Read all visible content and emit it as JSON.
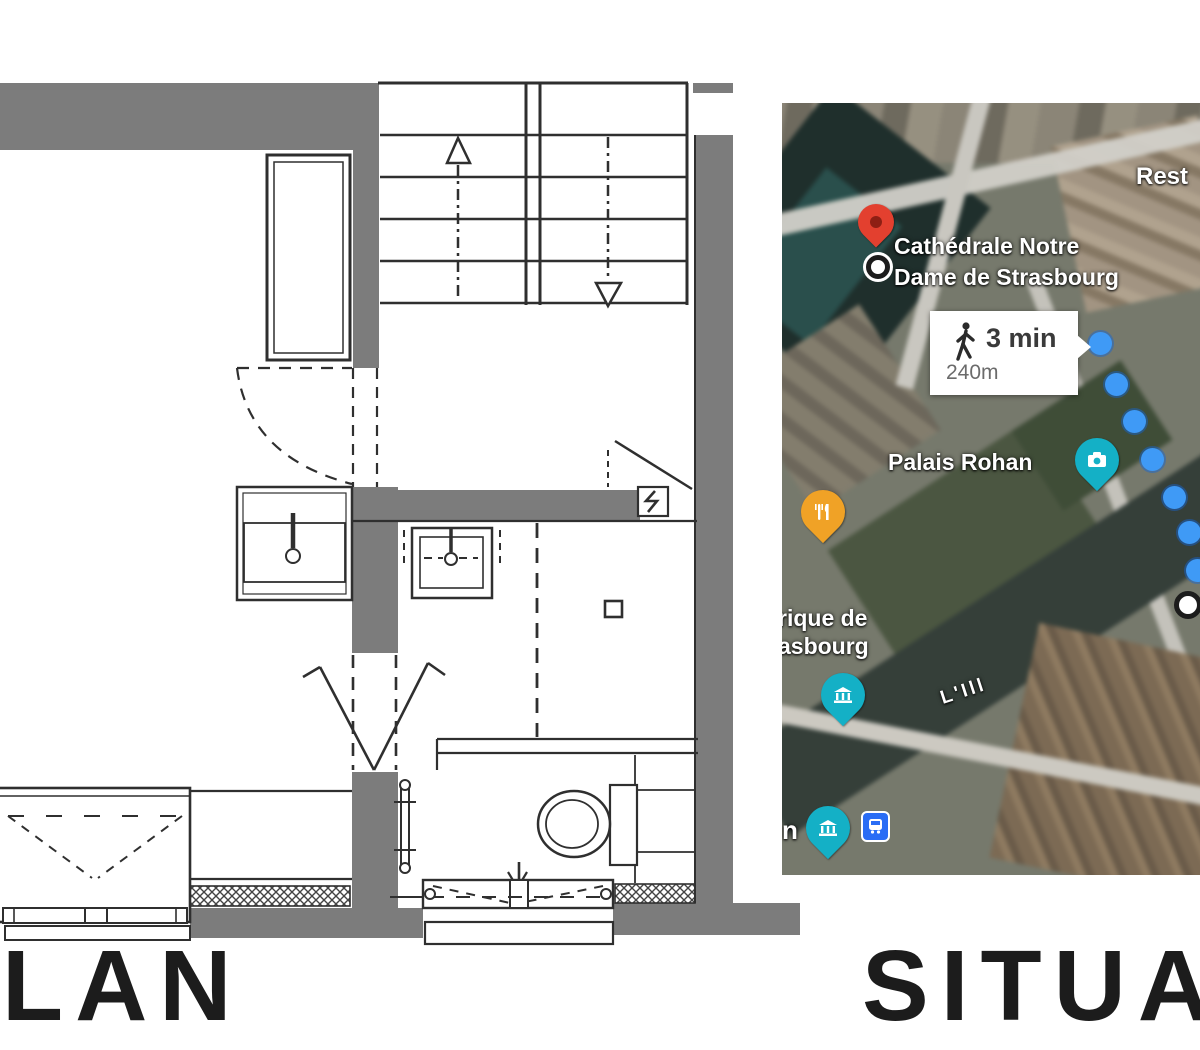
{
  "captions": {
    "left": "LAN",
    "right": "SITUA"
  },
  "floor_plan": {
    "wall_color": "#7c7c7c",
    "line_color": "#2f2f2f",
    "fixtures": [
      "staircase-up",
      "staircase-down",
      "closet",
      "sink",
      "washbasin",
      "toilet",
      "french-window",
      "window",
      "entrance-door-swing",
      "radiator",
      "electrical-panel"
    ]
  },
  "map": {
    "poi": {
      "cathedral_line1": "Cathédrale Notre",
      "cathedral_line2": "Dame de Strasbourg",
      "palais": "Palais Rohan",
      "museum_partial_line1": "rique de",
      "museum_partial_line2": "asbourg",
      "restaurant_partial": "Rest",
      "river": "L'Ill",
      "partial_n": "n"
    },
    "directions": {
      "duration": "3 min",
      "distance": "240m"
    },
    "colors": {
      "pin_red": "#e3402f",
      "pin_orange": "#f0a226",
      "pin_teal": "#14b0c6",
      "bus_blue": "#2a6df5",
      "route_blue": "#3f9af6"
    }
  }
}
